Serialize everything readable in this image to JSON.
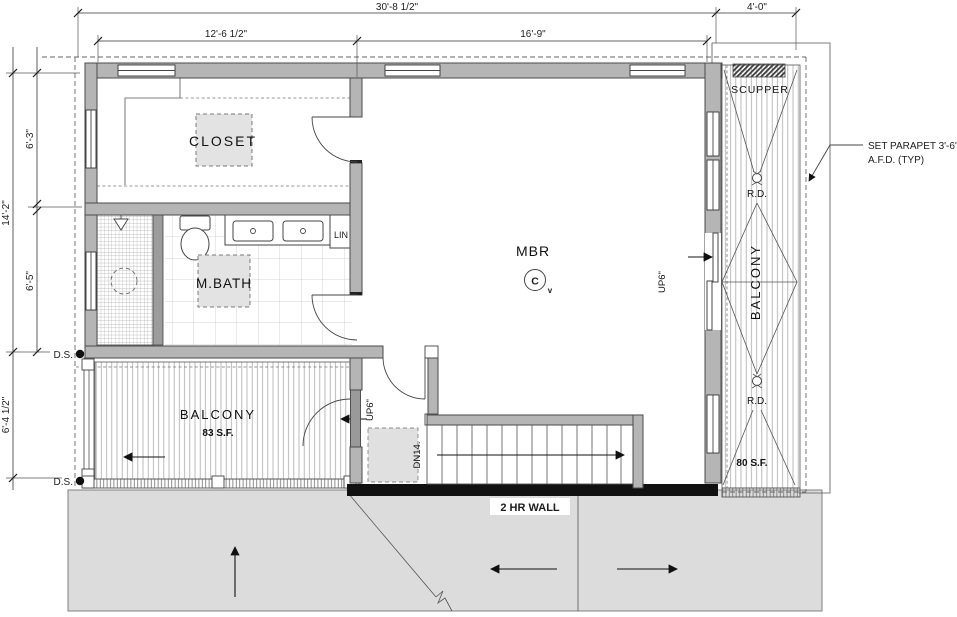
{
  "dims": {
    "overall_width": "30'-8 1/2\"",
    "seg_left": "12'-6 1/2\"",
    "seg_right": "16'-9\"",
    "balcony_east_width": "4'-0\"",
    "overall_depth": "14'-2\"",
    "depth_upper": "6'-3\"",
    "depth_lower": "6'-5\"",
    "balcony_west_depth": "6'-4 1/2\""
  },
  "rooms": {
    "closet": "CLOSET",
    "mbath": "M.BATH",
    "linen": "LIN",
    "mbr": "MBR",
    "balcony_west": "BALCONY",
    "balcony_west_area": "83 S.F.",
    "balcony_east": "BALCONY",
    "balcony_east_area": "80 S.F."
  },
  "labels": {
    "scupper": "SCUPPER",
    "roof_drain_upper": "R.D.",
    "roof_drain_lower": "R.D.",
    "downspout_upper": "D.S.",
    "downspout_lower": "D.S.",
    "up_west": "UP6\"",
    "up_east": "UP6\"",
    "down_stairs": "DN14.",
    "fire_wall": "2 HR WALL",
    "parapet_note_1": "SET PARAPET 3'-6\"",
    "parapet_note_2": "A.F.D. (TYP)",
    "ceiling_fan": "C",
    "ceiling_fan_sub": "v"
  },
  "colors": {
    "wall": "#b5b5b5",
    "wall_outline": "#4a4a4a",
    "fire_wall": "#111111",
    "lower_roof": "#dcdcdc",
    "skylight_fill": "#e3e3e3",
    "line": "#444444"
  }
}
